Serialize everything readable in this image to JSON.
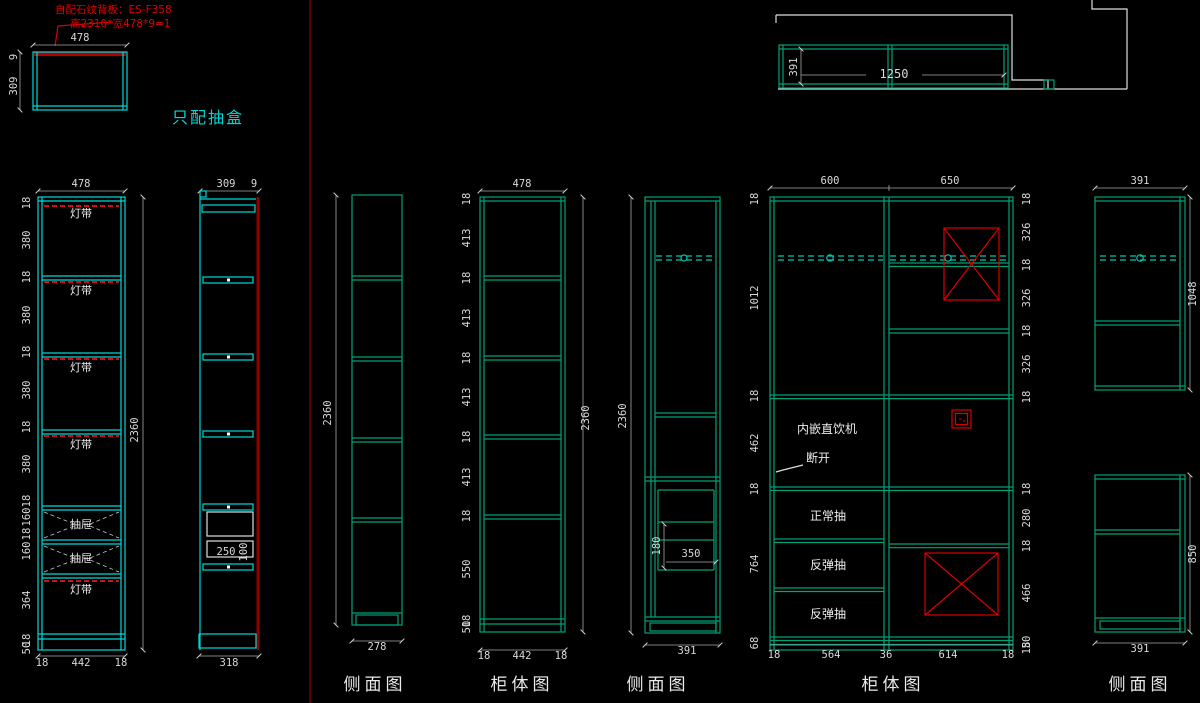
{
  "note": {
    "line1": "自配石纹背板：ES-F358",
    "line2": "高2310*宽478*9=1"
  },
  "section_label": "只配抽盒",
  "labels": {
    "light_strip": "灯带",
    "drawer": "抽屉",
    "water_dispenser": "内嵌直饮机",
    "break_off": "断开",
    "normal_drawer": "正常抽",
    "rebound_drawer": "反弹抽"
  },
  "titles": {
    "v1": "侧面图",
    "v2": "柜体图",
    "v3": "侧面图",
    "v4": "柜体图",
    "v5": "侧面图"
  },
  "plan_a": {
    "w": "478",
    "d": "309",
    "t": "9"
  },
  "cab_b": {
    "top": "478",
    "h": "2360",
    "left": [
      "18",
      "380",
      "18",
      "380",
      "18",
      "380",
      "18",
      "380",
      "18",
      "160",
      "18",
      "160",
      "364",
      "18",
      "50"
    ],
    "bottom": [
      "18",
      "442",
      "18"
    ]
  },
  "cab_c": {
    "top_d": "309",
    "top_t": "9",
    "box_w": "250",
    "box_h": "100",
    "bottom": "318"
  },
  "cab_d": {
    "h": "2360",
    "bottom": "278"
  },
  "cab_e": {
    "top": "478",
    "h": "2360",
    "left": [
      "18",
      "413",
      "18",
      "413",
      "18",
      "413",
      "18",
      "413",
      "18",
      "550",
      "18",
      "50"
    ],
    "bottom": [
      "18",
      "442",
      "18"
    ]
  },
  "cab_f": {
    "h": "2360",
    "box_h": "180",
    "box_w": "350",
    "bottom": "391"
  },
  "cab_g": {
    "top": [
      "600",
      "650"
    ],
    "left": [
      "18",
      "1012",
      "18",
      "462",
      "18",
      "764",
      "68"
    ],
    "right_top": [
      "18",
      "326",
      "18",
      "326",
      "18",
      "326",
      "18"
    ],
    "right_bottom": [
      "18",
      "280",
      "18",
      "466",
      "50",
      "18"
    ],
    "bottom": [
      "18",
      "564",
      "36",
      "614",
      "18"
    ]
  },
  "cab_h": {
    "top": "391",
    "h_top": "1048",
    "h_bottom": "850",
    "bottom": "391"
  },
  "plan_i": {
    "d": "391",
    "w": "1250"
  }
}
